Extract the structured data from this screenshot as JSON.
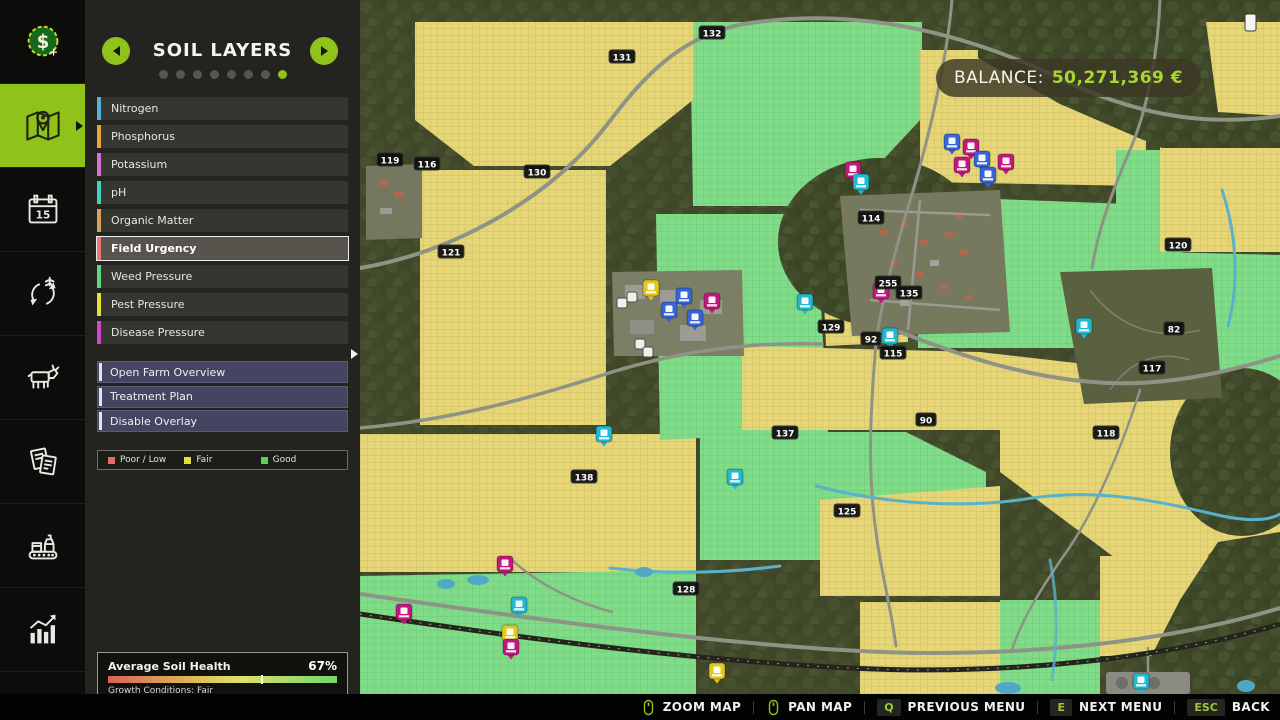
{
  "accent_color": "#8fc31c",
  "sidebar": {
    "items": [
      {
        "name": "finances",
        "active": false
      },
      {
        "name": "map",
        "active": true
      },
      {
        "name": "calendar",
        "active": false
      },
      {
        "name": "crop-rotation",
        "active": false
      },
      {
        "name": "animals",
        "active": false
      },
      {
        "name": "contracts",
        "active": false
      },
      {
        "name": "production",
        "active": false
      },
      {
        "name": "statistics",
        "active": false
      },
      {
        "name": "settings",
        "active": false
      }
    ],
    "calendar_day": "15",
    "money_symbol": "$",
    "money_plus": "+"
  },
  "panel": {
    "title": "SOIL LAYERS",
    "page_dots": {
      "total": 8,
      "active_index": 7
    },
    "layers": [
      {
        "label": "Nitrogen",
        "color": "#5aaede",
        "selected": false
      },
      {
        "label": "Phosphorus",
        "color": "#e8a33d",
        "selected": false
      },
      {
        "label": "Potassium",
        "color": "#d66fd0",
        "selected": false
      },
      {
        "label": "pH",
        "color": "#3ed3c2",
        "selected": false
      },
      {
        "label": "Organic Matter",
        "color": "#d8a05a",
        "selected": false
      },
      {
        "label": "Field Urgency",
        "color": "#e87878",
        "selected": true
      },
      {
        "label": "Weed Pressure",
        "color": "#5fd67f",
        "selected": false
      },
      {
        "label": "Pest Pressure",
        "color": "#e8e13c",
        "selected": false
      },
      {
        "label": "Disease Pressure",
        "color": "#cc49c8",
        "selected": false
      }
    ],
    "actions": [
      "Open Farm Overview",
      "Treatment Plan",
      "Disable Overlay"
    ],
    "legend": [
      {
        "label": "Poor / Low",
        "color": "#e46a6a"
      },
      {
        "label": "Fair",
        "color": "#e6db3f"
      },
      {
        "label": "Good",
        "color": "#58d35a"
      }
    ],
    "soil_health": {
      "label": "Average Soil Health",
      "value_pct": 67,
      "value_label": "67%",
      "caption": "Growth Conditions: Fair"
    }
  },
  "hud": {
    "balance_label": "BALANCE:",
    "balance_value": "50,271,369 €"
  },
  "bottom_bar": {
    "items": [
      {
        "icon": "mouse-zoom",
        "key": null,
        "label": "ZOOM MAP"
      },
      {
        "icon": "mouse-pan",
        "key": null,
        "label": "PAN MAP"
      },
      {
        "icon": null,
        "key": "Q",
        "label": "PREVIOUS MENU"
      },
      {
        "icon": null,
        "key": "E",
        "label": "NEXT MENU"
      },
      {
        "icon": null,
        "key": "ESC",
        "label": "BACK"
      }
    ]
  },
  "map": {
    "marker_colors": {
      "blue": "#3565d6",
      "magenta": "#c2187e",
      "cyan": "#22b8cf",
      "yellow": "#e3c71f",
      "white": "#f2f2f2"
    },
    "field_labels": [
      {
        "n": "132",
        "x": 352,
        "y": 33
      },
      {
        "n": "131",
        "x": 262,
        "y": 57
      },
      {
        "n": "119",
        "x": 30,
        "y": 160
      },
      {
        "n": "116",
        "x": 67,
        "y": 164
      },
      {
        "n": "130",
        "x": 177,
        "y": 172
      },
      {
        "n": "121",
        "x": 91,
        "y": 252
      },
      {
        "n": "114",
        "x": 511,
        "y": 218
      },
      {
        "n": "255",
        "x": 528,
        "y": 283
      },
      {
        "n": "135",
        "x": 549,
        "y": 293
      },
      {
        "n": "129",
        "x": 471,
        "y": 327
      },
      {
        "n": "92",
        "x": 511,
        "y": 339
      },
      {
        "n": "115",
        "x": 533,
        "y": 353
      },
      {
        "n": "120",
        "x": 818,
        "y": 245
      },
      {
        "n": "82",
        "x": 814,
        "y": 329
      },
      {
        "n": "117",
        "x": 792,
        "y": 368
      },
      {
        "n": "137",
        "x": 425,
        "y": 433
      },
      {
        "n": "138",
        "x": 224,
        "y": 477
      },
      {
        "n": "128",
        "x": 326,
        "y": 589
      },
      {
        "n": "118",
        "x": 746,
        "y": 433
      },
      {
        "n": "90",
        "x": 566,
        "y": 420
      },
      {
        "n": "125",
        "x": 487,
        "y": 511
      }
    ],
    "markers": [
      {
        "c": "blue",
        "x": 592,
        "y": 143
      },
      {
        "c": "magenta",
        "x": 611,
        "y": 148
      },
      {
        "c": "magenta",
        "x": 602,
        "y": 166
      },
      {
        "c": "blue",
        "x": 622,
        "y": 160
      },
      {
        "c": "blue",
        "x": 628,
        "y": 176
      },
      {
        "c": "magenta",
        "x": 646,
        "y": 163
      },
      {
        "c": "magenta",
        "x": 493,
        "y": 171
      },
      {
        "c": "cyan",
        "x": 501,
        "y": 183
      },
      {
        "c": "yellow",
        "x": 291,
        "y": 289
      },
      {
        "c": "blue",
        "x": 324,
        "y": 297
      },
      {
        "c": "blue",
        "x": 309,
        "y": 311
      },
      {
        "c": "blue",
        "x": 335,
        "y": 319
      },
      {
        "c": "magenta",
        "x": 352,
        "y": 302
      },
      {
        "c": "white",
        "x": 272,
        "y": 297
      },
      {
        "c": "white",
        "x": 262,
        "y": 303
      },
      {
        "c": "white",
        "x": 280,
        "y": 344
      },
      {
        "c": "white",
        "x": 288,
        "y": 352
      },
      {
        "c": "cyan",
        "x": 445,
        "y": 303
      },
      {
        "c": "magenta",
        "x": 521,
        "y": 292
      },
      {
        "c": "cyan",
        "x": 530,
        "y": 337
      },
      {
        "c": "cyan",
        "x": 724,
        "y": 327
      },
      {
        "c": "cyan",
        "x": 244,
        "y": 435
      },
      {
        "c": "cyan",
        "x": 375,
        "y": 478
      },
      {
        "c": "magenta",
        "x": 145,
        "y": 565
      },
      {
        "c": "cyan",
        "x": 159,
        "y": 606
      },
      {
        "c": "magenta",
        "x": 44,
        "y": 613
      },
      {
        "c": "yellow",
        "x": 150,
        "y": 634
      },
      {
        "c": "magenta",
        "x": 151,
        "y": 648
      },
      {
        "c": "yellow",
        "x": 357,
        "y": 672
      },
      {
        "c": "cyan",
        "x": 781,
        "y": 682
      }
    ]
  }
}
